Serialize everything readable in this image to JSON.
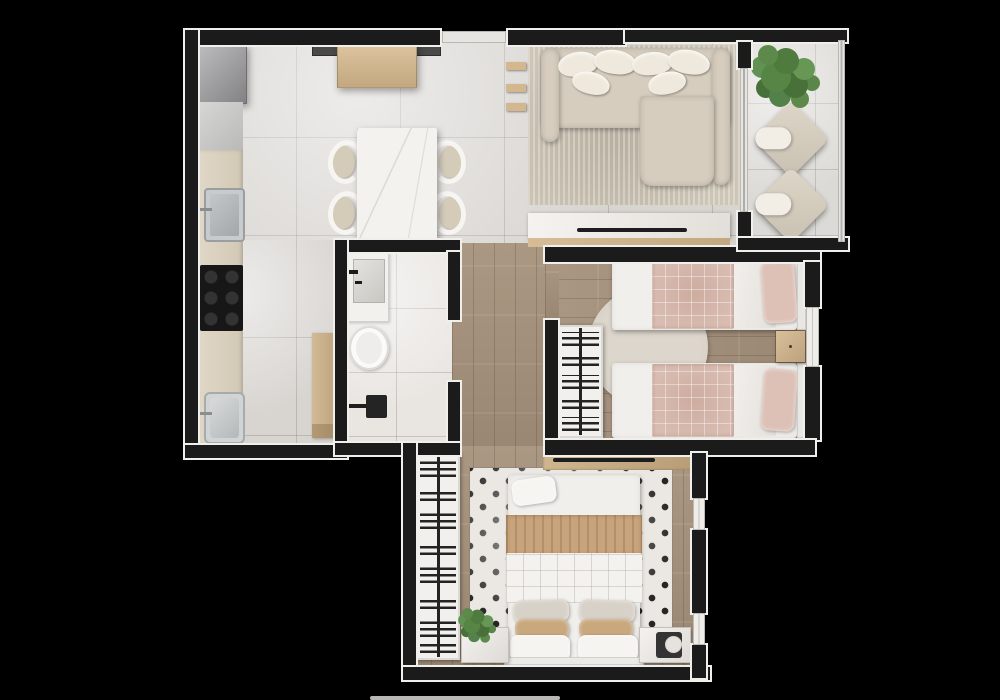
{
  "meta": {
    "type": "apartment floor plan, top-down 3D render",
    "background_color": "#000000",
    "visible_text": "none"
  },
  "palette": {
    "walls": "#1b1b1c",
    "wall_trim": "#f1efec",
    "tile_floor": "#d8d5d1",
    "wood_floor": "#a5927e",
    "accent_pink": "#d9bdb2",
    "accent_tan": "#c8a47d",
    "plant_green": "#5d8a4b",
    "upholstery": "#d6cdbe"
  },
  "rooms": [
    {
      "id": "kitchen",
      "name": "Kitchen",
      "floor": "light tile",
      "furniture": [
        "refrigerator",
        "base cabinets",
        "kitchen sink",
        "cooktop",
        "laundry sink",
        "tall wood cabinet"
      ]
    },
    {
      "id": "dining",
      "name": "Dining Area",
      "floor": "light tile",
      "furniture": [
        "wood sideboard",
        "marble dining table",
        "four chairs"
      ]
    },
    {
      "id": "living",
      "name": "Living Room",
      "floor": "light tile",
      "furniture": [
        "sectional sofa with pillows",
        "area rug",
        "wall shelves",
        "TV console with TV"
      ]
    },
    {
      "id": "balcony",
      "name": "Balcony",
      "floor": "tile",
      "furniture": [
        "potted plant",
        "two lounge chairs",
        "glass railing",
        "sliding glass door"
      ]
    },
    {
      "id": "bathroom",
      "name": "Bathroom",
      "floor": "white tile",
      "furniture": [
        "vanity with basin",
        "toilet",
        "shower with fixture"
      ]
    },
    {
      "id": "hallway",
      "name": "Hallway",
      "floor": "wood",
      "furniture": []
    },
    {
      "id": "twin_bedroom",
      "name": "Bedroom with Twin Beds",
      "floor": "wood",
      "furniture": [
        "two single beds with pink quilts and pillows",
        "round rug",
        "wood nightstand",
        "open wardrobe with hanging clothes",
        "window"
      ]
    },
    {
      "id": "master_bedroom",
      "name": "Bedroom with Double Bed",
      "floor": "wood",
      "furniture": [
        "double bed with tan throw",
        "patterned rug",
        "TV panel",
        "open wardrobe with hanging clothes",
        "nightstand with plant",
        "nightstand with speaker",
        "two windows"
      ]
    }
  ]
}
